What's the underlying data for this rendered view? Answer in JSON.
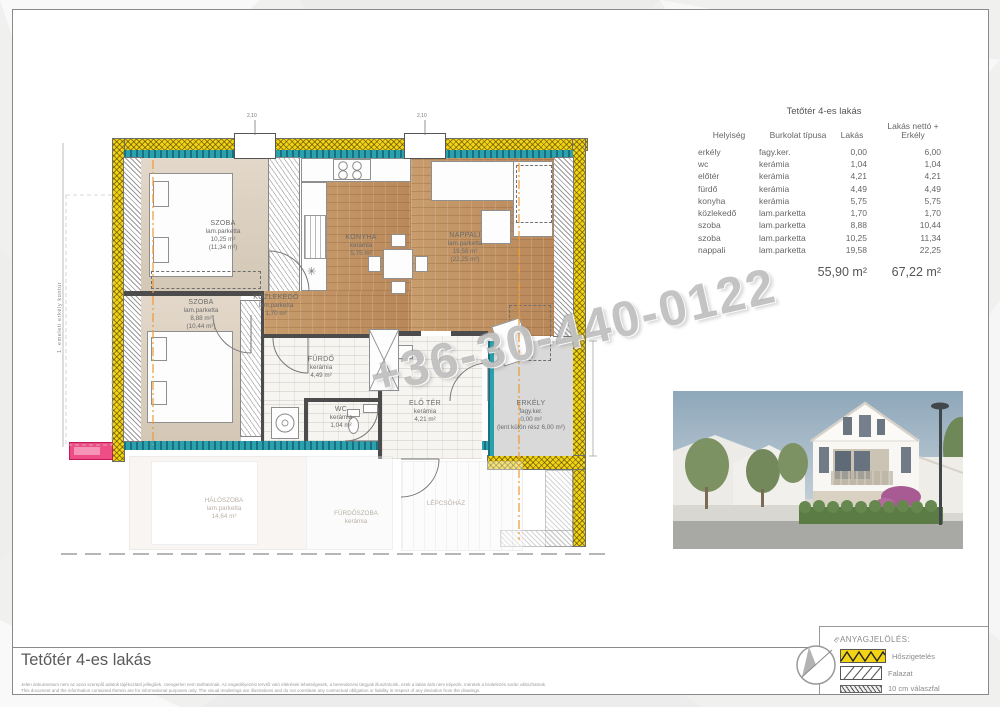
{
  "watermark": "+36-30-440-0122",
  "doc": {
    "title": "Tetőtér 4-es lakás",
    "disclaimer_hu": "Jelen dokumentum nem az azon szereplő adatok tájékoztató jellegűek, csengerlen nem tarthatónak. Az engedélyezési tervtől való eltérések lehetségesek, a berendezési tárgyak illusztrációk, ezek a lakás árát nem képezik, méretek a kivitelezés során változhatnak.",
    "disclaimer_en": "This document and the information contained therein are for informational purposes only. The visual renderings are illustrations and do not constitute any contractual obligation or liability in respect of any deviation from the drawings."
  },
  "table": {
    "title": "Tetőtér 4-es lakás",
    "headers": [
      "Helyiség",
      "Burkolat típusa",
      "Lakás",
      "Lakás nettó + Erkély"
    ],
    "rows": [
      {
        "name": "erkély",
        "mat": "fagy.ker.",
        "a": "0,00",
        "b": "6,00"
      },
      {
        "name": "wc",
        "mat": "kerámia",
        "a": "1,04",
        "b": "1,04"
      },
      {
        "name": "előtér",
        "mat": "kerámia",
        "a": "4,21",
        "b": "4,21"
      },
      {
        "name": "fürdő",
        "mat": "kerámia",
        "a": "4,49",
        "b": "4,49"
      },
      {
        "name": "konyha",
        "mat": "kerámia",
        "a": "5,75",
        "b": "5,75"
      },
      {
        "name": "közlekedő",
        "mat": "lam.parketta",
        "a": "1,70",
        "b": "1,70"
      },
      {
        "name": "szoba",
        "mat": "lam.parketta",
        "a": "8,88",
        "b": "10,44"
      },
      {
        "name": "szoba",
        "mat": "lam.parketta",
        "a": "10,25",
        "b": "11,34"
      },
      {
        "name": "nappali",
        "mat": "lam.parketta",
        "a": "19,58",
        "b": "22,25"
      }
    ],
    "totals": {
      "lakas": "55,90 m²",
      "netto": "67,22 m²"
    }
  },
  "plan": {
    "rooms": {
      "szoba1": {
        "name": "SZOBA",
        "mat": "lam.parketta",
        "a": "10,25 m²",
        "b": "(11,34 m²)"
      },
      "szoba2": {
        "name": "SZOBA",
        "mat": "lam.parketta",
        "a": "8,88 m²",
        "b": "(10,44 m²)"
      },
      "konyha": {
        "name": "KONYHA",
        "mat": "kerámia",
        "a": "5,75 m²"
      },
      "nappali": {
        "name": "NAPPALI",
        "mat": "lam.parketta",
        "a": "19,58 m²",
        "b": "(22,25 m²)"
      },
      "kozlekedo": {
        "name": "KÖZLEKEDŐ",
        "mat": "lam.parketta",
        "a": "1,70 m²"
      },
      "furdo": {
        "name": "FÜRDŐ",
        "mat": "kerámia",
        "a": "4,49 m²"
      },
      "wc": {
        "name": "WC",
        "mat": "kerámia",
        "a": "1,04 m²"
      },
      "eloter": {
        "name": "ELŐ TÉR",
        "mat": "kerámia",
        "a": "4,21 m²"
      },
      "erkely": {
        "name": "ERKÉLY",
        "mat": "fagy.ker.",
        "a": "0,00 m²",
        "b": "(lent külön rész 6,00 m²)"
      }
    },
    "left_note": "1. emeleti erkély kontúr",
    "skylight_dim": "2,10",
    "ghost": {
      "haloszoba": {
        "name": "HÁLÓSZOBA",
        "mat": "lam.parketta",
        "a": "14,64 m²"
      },
      "furdoszoba": {
        "name": "FÜRDŐSZOBA",
        "mat": "kerámia"
      },
      "lepcsohaz": {
        "name": "LÉPCSŐHÁZ"
      }
    }
  },
  "legend": {
    "title": "ANYAGJELÖLÉS:",
    "items": [
      {
        "label": "Hőszigetelés"
      },
      {
        "label": "Falazat"
      },
      {
        "label": "10 cm válaszfal"
      }
    ],
    "north": "É"
  },
  "colors": {
    "insulation_yellow": "#f2d315",
    "wall_finish_teal": "#2aa2ac",
    "wood_floor": "#c49767",
    "marker_pink": "#ef4d86"
  }
}
